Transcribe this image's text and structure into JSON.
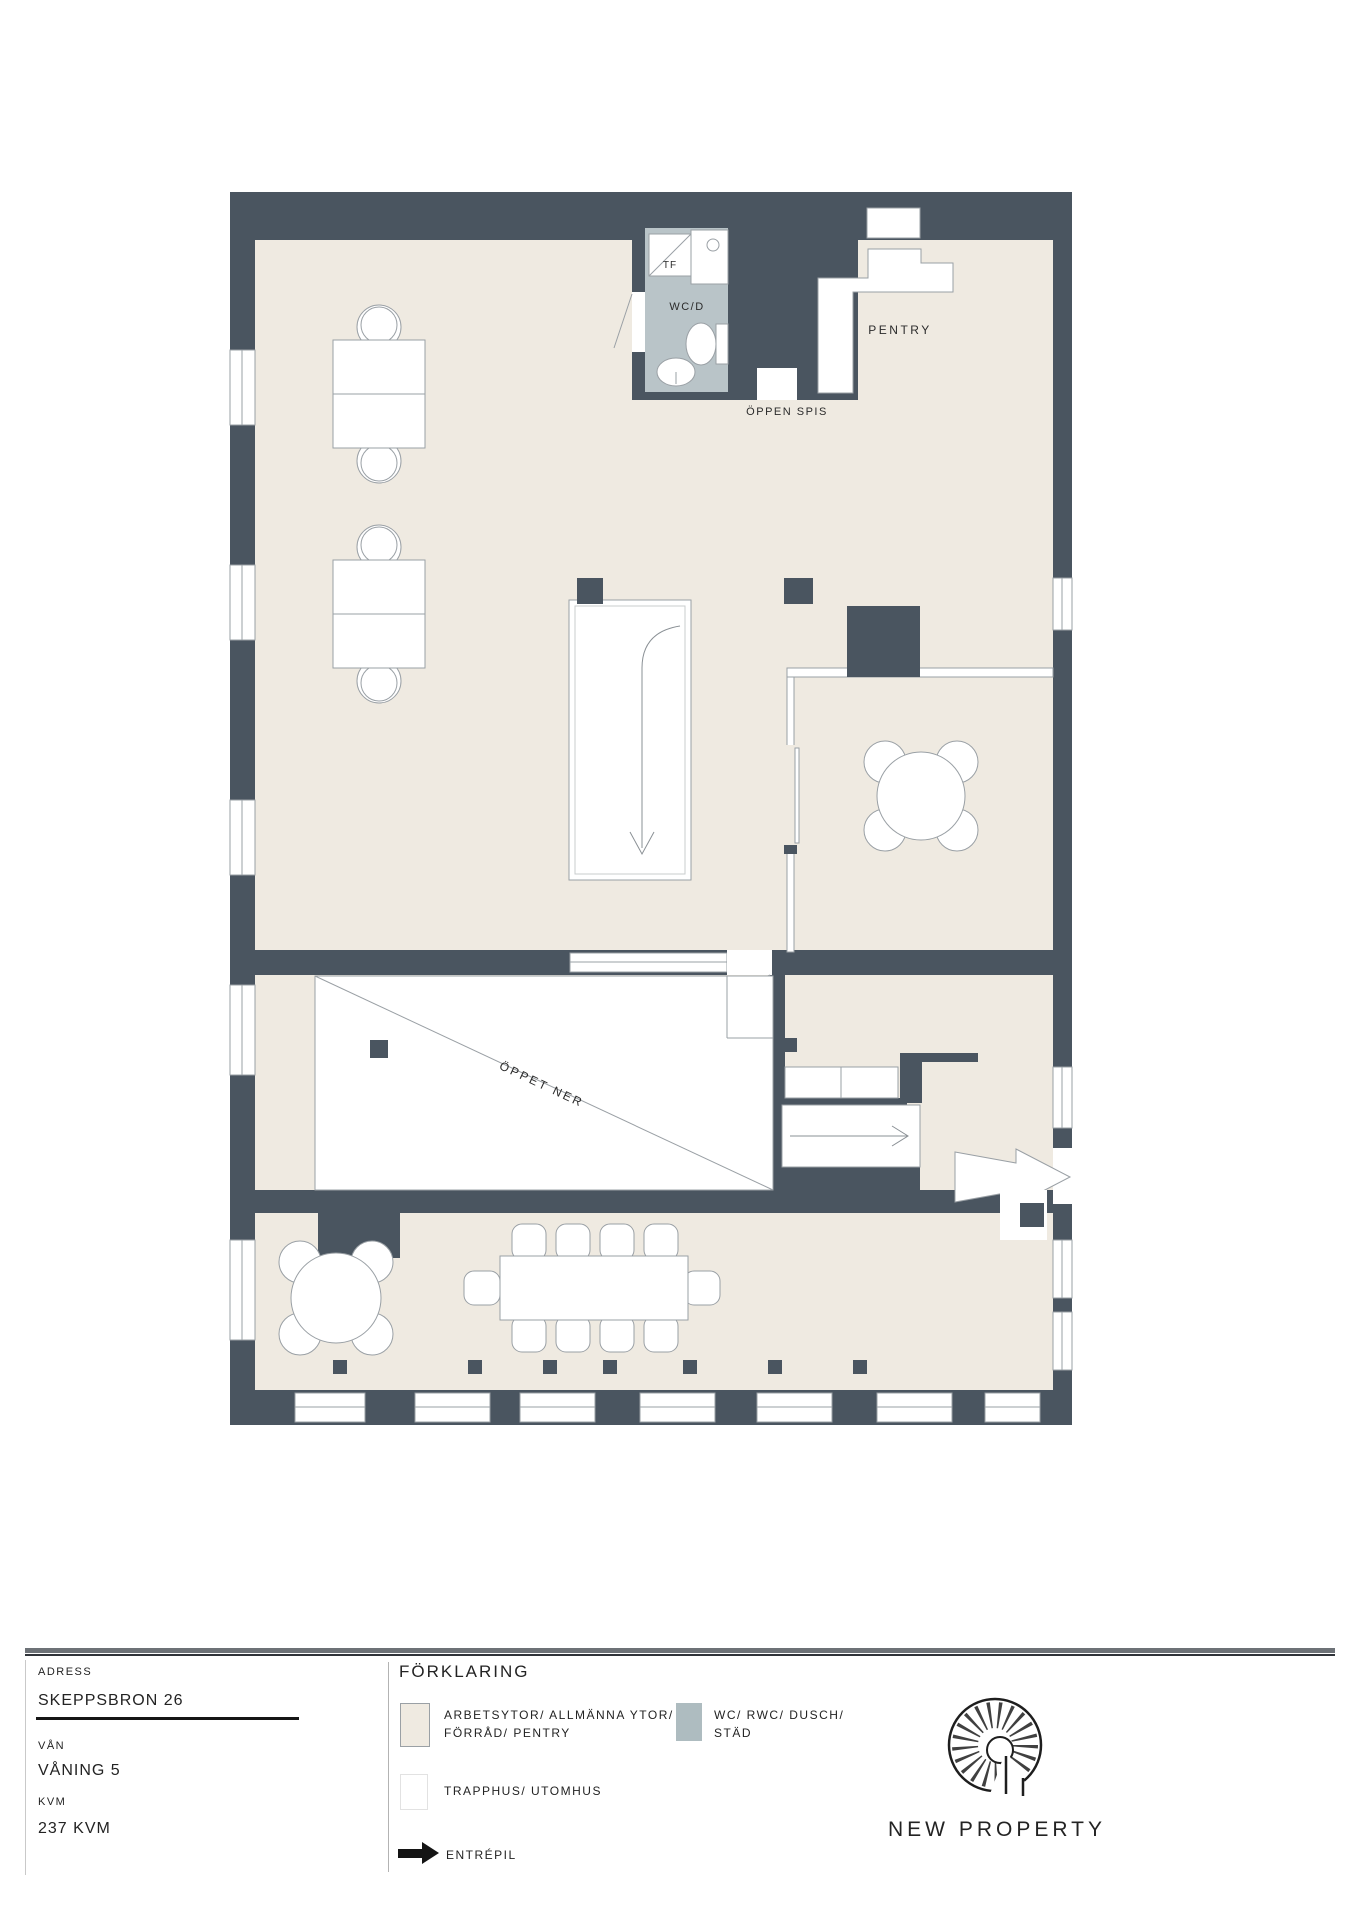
{
  "plan": {
    "labels": {
      "tf": "TF",
      "wcd": "WC/D",
      "pentry": "PENTRY",
      "oppen_spis": "ÖPPEN SPIS",
      "oppet_ner": "ÖPPET NER"
    }
  },
  "info": {
    "address_label": "ADRESS",
    "address_value": "SKEPPSBRON 26",
    "floor_label": "VÅN",
    "floor_value": "VÅNING 5",
    "area_label": "KVM",
    "area_value": "237 KVM"
  },
  "legend": {
    "title": "FÖRKLARING",
    "items": [
      {
        "label_line1": "ARBETSYTOR/ ALLMÄNNA YTOR/",
        "label_line2": "FÖRRÅD/ PENTRY",
        "swatch": "#efeae1"
      },
      {
        "label_line1": "WC/ RWC/ DUSCH/",
        "label_line2": "STÄD",
        "swatch": "#aebcc0"
      },
      {
        "label_line1": "TRAPPHUS/ UTOMHUS",
        "label_line2": "",
        "swatch": "#ffffff"
      },
      {
        "label": "ENTRÉPIL",
        "icon": "right-arrow"
      }
    ]
  },
  "brand": {
    "name": "NEW PROPERTY",
    "icon": "spiral-staircase"
  },
  "colors": {
    "wall": "#4a5560",
    "floor": "#efeae1",
    "wet_room": "#b9c4c8",
    "line": "#9aa0a5"
  }
}
